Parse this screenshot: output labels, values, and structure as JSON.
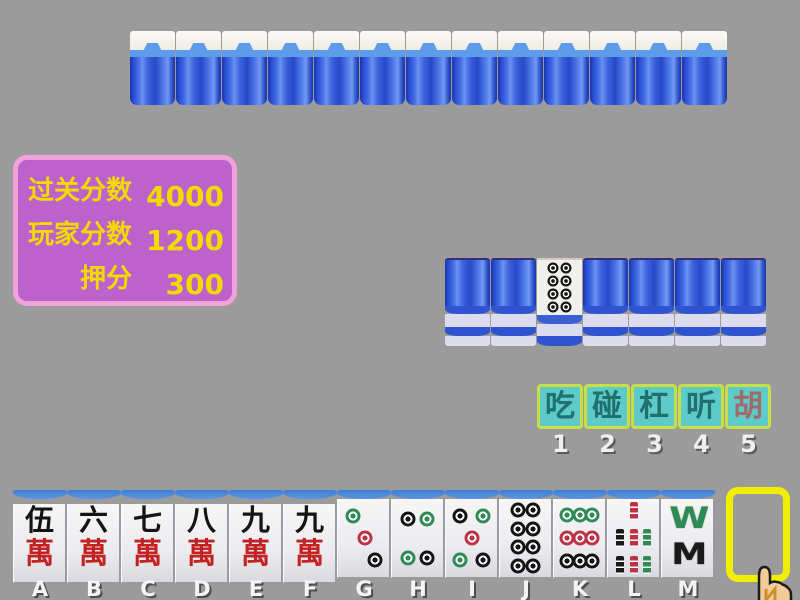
{
  "colors": {
    "background": "#9b9b9b",
    "panel_bg": "#be62cb",
    "panel_border": "#f0a2da",
    "panel_text": "#f0da00",
    "button_bg": "#5ecaca",
    "button_border": "#c8e046",
    "button_text": "#20706e",
    "hu_button_text": "#a06b6b",
    "tile_back_blue": "#2e54d2",
    "draw_slot_border": "#f2ee00"
  },
  "score_panel": {
    "rows": [
      {
        "label": "过关分数",
        "value": "4000"
      },
      {
        "label": "玩家分数",
        "value": "1200"
      },
      {
        "label": "押分",
        "value": "300"
      }
    ]
  },
  "opponent_row": {
    "count": 13,
    "style": "face-down-back"
  },
  "middle_row": {
    "tiles": [
      "back",
      "back",
      "face-dot-8",
      "back",
      "back",
      "back",
      "back"
    ],
    "face_tile_name": "8-dot"
  },
  "action_buttons": [
    {
      "id": "chi",
      "label": "吃",
      "hotkey": "1"
    },
    {
      "id": "peng",
      "label": "碰",
      "hotkey": "2"
    },
    {
      "id": "gang",
      "label": "杠",
      "hotkey": "3"
    },
    {
      "id": "ting",
      "label": "听",
      "hotkey": "4"
    },
    {
      "id": "hu",
      "label": "胡",
      "hotkey": "5",
      "accent": true
    }
  ],
  "hand_tiles": [
    {
      "key": "A",
      "kind": "wan",
      "top": "伍",
      "bottom": "萬",
      "name": "5-wan"
    },
    {
      "key": "B",
      "kind": "wan",
      "top": "六",
      "bottom": "萬",
      "name": "6-wan"
    },
    {
      "key": "C",
      "kind": "wan",
      "top": "七",
      "bottom": "萬",
      "name": "7-wan"
    },
    {
      "key": "D",
      "kind": "wan",
      "top": "八",
      "bottom": "萬",
      "name": "8-wan"
    },
    {
      "key": "E",
      "kind": "wan",
      "top": "九",
      "bottom": "萬",
      "name": "9-wan"
    },
    {
      "key": "F",
      "kind": "wan",
      "top": "九",
      "bottom": "萬",
      "name": "9-wan"
    },
    {
      "key": "G",
      "kind": "dot",
      "dots": "dot3",
      "name": "3-dot"
    },
    {
      "key": "H",
      "kind": "dot",
      "dots": "dot4",
      "name": "4-dot"
    },
    {
      "key": "I",
      "kind": "dot",
      "dots": "dot5",
      "name": "5-dot"
    },
    {
      "key": "J",
      "kind": "dot",
      "dots": "dot8",
      "name": "8-dot"
    },
    {
      "key": "K",
      "kind": "dot",
      "dots": "dot9",
      "name": "9-dot"
    },
    {
      "key": "L",
      "kind": "bamboo",
      "sticks": "bam7",
      "name": "7-bamboo"
    },
    {
      "key": "M",
      "kind": "bamboo8",
      "letters": [
        "W",
        "M"
      ],
      "name": "8-bamboo"
    }
  ],
  "layouts": {
    "dot3": [
      {
        "x": 30,
        "y": 22,
        "c": "green"
      },
      {
        "x": 52,
        "y": 50,
        "c": "red"
      },
      {
        "x": 72,
        "y": 78,
        "c": "black"
      }
    ],
    "dot4": [
      {
        "x": 31,
        "y": 25,
        "c": "black"
      },
      {
        "x": 69,
        "y": 25,
        "c": "green"
      },
      {
        "x": 31,
        "y": 75,
        "c": "green"
      },
      {
        "x": 69,
        "y": 75,
        "c": "black"
      }
    ],
    "dot5": [
      {
        "x": 28,
        "y": 22,
        "c": "black"
      },
      {
        "x": 72,
        "y": 22,
        "c": "green"
      },
      {
        "x": 50,
        "y": 50,
        "c": "red"
      },
      {
        "x": 28,
        "y": 78,
        "c": "green"
      },
      {
        "x": 72,
        "y": 78,
        "c": "black"
      }
    ],
    "dot8": [
      {
        "x": 35,
        "y": 14,
        "c": "black"
      },
      {
        "x": 65,
        "y": 14,
        "c": "black"
      },
      {
        "x": 35,
        "y": 38,
        "c": "black"
      },
      {
        "x": 65,
        "y": 38,
        "c": "black"
      },
      {
        "x": 35,
        "y": 62,
        "c": "black"
      },
      {
        "x": 65,
        "y": 62,
        "c": "black"
      },
      {
        "x": 35,
        "y": 86,
        "c": "black"
      },
      {
        "x": 65,
        "y": 86,
        "c": "black"
      }
    ],
    "dot9": [
      {
        "x": 25,
        "y": 20,
        "c": "green"
      },
      {
        "x": 50,
        "y": 20,
        "c": "green"
      },
      {
        "x": 75,
        "y": 20,
        "c": "green"
      },
      {
        "x": 25,
        "y": 50,
        "c": "red"
      },
      {
        "x": 50,
        "y": 50,
        "c": "red"
      },
      {
        "x": 75,
        "y": 50,
        "c": "red"
      },
      {
        "x": 25,
        "y": 80,
        "c": "black"
      },
      {
        "x": 50,
        "y": 80,
        "c": "black"
      },
      {
        "x": 75,
        "y": 80,
        "c": "black"
      }
    ],
    "bam7": [
      {
        "x": 50,
        "y": 16,
        "c": "red"
      },
      {
        "x": 24,
        "y": 50,
        "c": "black"
      },
      {
        "x": 50,
        "y": 50,
        "c": "red"
      },
      {
        "x": 76,
        "y": 50,
        "c": "green"
      },
      {
        "x": 24,
        "y": 84,
        "c": "black"
      },
      {
        "x": 50,
        "y": 84,
        "c": "red"
      },
      {
        "x": 76,
        "y": 84,
        "c": "green"
      }
    ]
  }
}
